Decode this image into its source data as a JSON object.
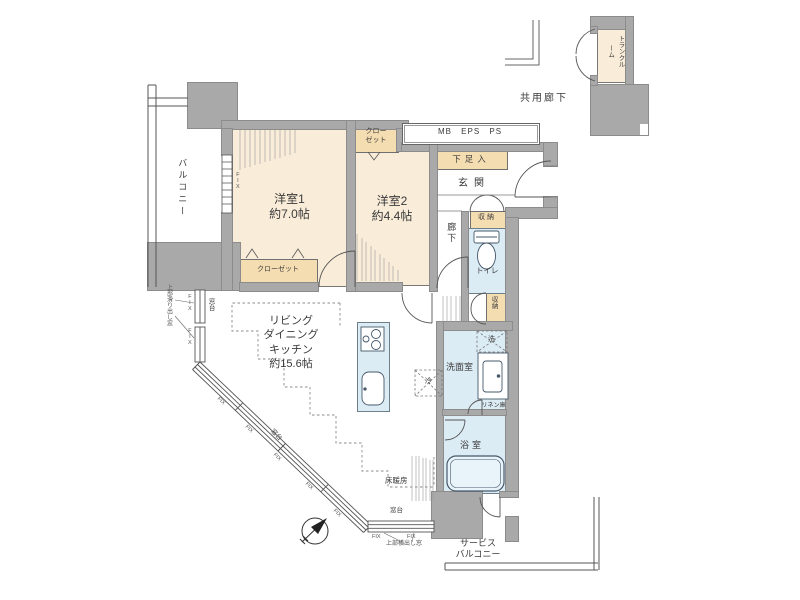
{
  "plan": {
    "rooms": {
      "bedroom1": {
        "name": "洋室1",
        "size": "約7.0帖"
      },
      "bedroom2": {
        "name": "洋室2",
        "size": "約4.4帖"
      },
      "ldk": {
        "name_line1": "リビング",
        "name_line2": "ダイニング",
        "name_line3": "キッチン",
        "size": "約15.6帖"
      },
      "entrance": "玄関",
      "hallway": "廊下",
      "toilet": "トイレ",
      "washroom": "洗面室",
      "bathroom": "浴室",
      "balcony": "バルコニー",
      "service_balcony_line1": "サービス",
      "service_balcony_line2": "バルコニー",
      "trunk_room": "トランクルーム",
      "common_corridor": "共用廊下"
    },
    "storage": {
      "closet1": "クローゼット",
      "closet2_line1": "クロー",
      "closet2_line2": "ゼット",
      "shoe_cabinet": "下足入",
      "storage": "収納",
      "linen": "リネン庫"
    },
    "fixtures": {
      "refrigerator": "冷",
      "washer": "洗"
    },
    "annotations": {
      "mb_eps_ps": "MB EPS PS",
      "floor_heating": "床暖房",
      "window_sill": "窓台",
      "fix_window": "FIX",
      "window_note_left": "上部滑り出し窓",
      "window_note_bottom": "上部横出し窓"
    },
    "colors": {
      "wall": "#a9a9a9",
      "room_cream": "#f9ecd9",
      "closet_tan": "#f5ddb2",
      "water_blue": "#dcecf5",
      "line": "#4a4a4a"
    }
  }
}
